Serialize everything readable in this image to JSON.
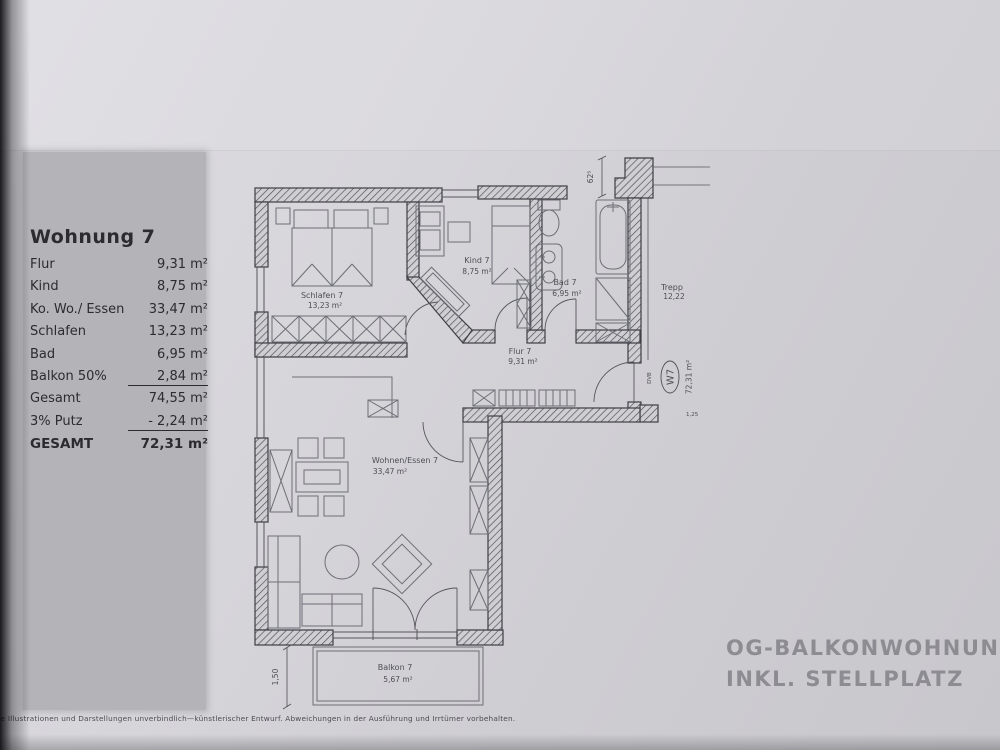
{
  "summary_table": {
    "title": "Wohnung 7",
    "rows": [
      {
        "label": "Flur",
        "value": "9,31 m²"
      },
      {
        "label": "Kind",
        "value": "8,75 m²"
      },
      {
        "label": "Ko. Wo./ Essen",
        "value": "33,47 m²"
      },
      {
        "label": "Schlafen",
        "value": "13,23 m²"
      },
      {
        "label": "Bad",
        "value": "6,95 m²"
      },
      {
        "label": "Balkon 50%",
        "value": "2,84 m²"
      },
      {
        "label": "Gesamt",
        "value": "74,55 m²"
      },
      {
        "label": "3% Putz",
        "value": "- 2,24 m²"
      },
      {
        "label": "GESAMT",
        "value": "72,31 m²"
      }
    ]
  },
  "plan": {
    "rooms": [
      {
        "name": "Schlafen 7",
        "area": "13,23 m²"
      },
      {
        "name": "Kind 7",
        "area": "8,75 m²"
      },
      {
        "name": "Bad 7",
        "area": "6,95 m²"
      },
      {
        "name": "Flur 7",
        "area": "9,31 m²"
      },
      {
        "name": "Wohnen/Essen 7",
        "area": "33,47 m²"
      },
      {
        "name": "Balkon 7",
        "area": "5,67 m²"
      }
    ],
    "stairs": {
      "label": "Trepp",
      "area": "12,22"
    },
    "unit_badge": {
      "code": "W7",
      "total_area": "72,31 m²",
      "door_code": "DVB"
    },
    "dimensions": {
      "top_wall": "62⁵",
      "balcony_depth": "1,50",
      "entry_step": "1,25"
    }
  },
  "watermark": {
    "line1": "OG-BALKONWOHNUNG",
    "line2": "INKL. STELLPLATZ"
  },
  "footer": {
    "disclaimer": "Alle Illustrationen und Darstellungen unverbindlich—künstlerischer Entwurf. Abweichungen in der Ausführung und Irrtümer vorbehalten."
  },
  "colors": {
    "paper": "#d3d2d7",
    "strip": "#b4b3b8",
    "ink": "#2b2b30",
    "plan_line": "#3e3e45",
    "furniture_line": "#6e6e77",
    "watermark": "#8d8c92"
  }
}
